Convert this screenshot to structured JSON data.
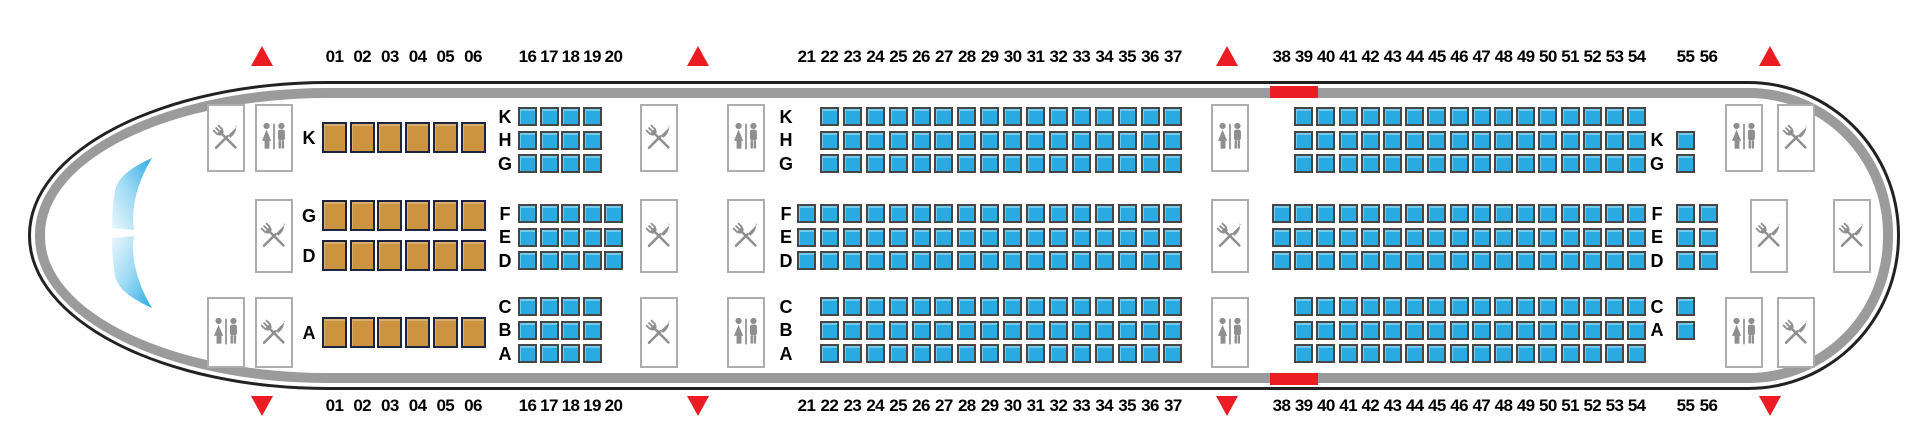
{
  "colors": {
    "economy_seat": "#29abe2",
    "economy_seat_border": "#464646",
    "business_seat": "#cd9440",
    "business_seat_border": "#1d2440",
    "fuselage_band": "#9b9b9b",
    "fuselage_outline": "#222222",
    "exit_marker": "#ec1c24",
    "icon_gray": "#8f8f8f",
    "text": "#000000"
  },
  "icons": {
    "galley": "crossed-fork-and-knife",
    "lavatory": "woman-and-man-figures",
    "exit": "red-triangle",
    "cockpit": "windshield-crescent-panes",
    "overwing_exit": "red-bar-on-fuselage"
  },
  "cabin": {
    "sections": [
      {
        "id": "business",
        "cabin_class": "business",
        "letters_visible": true,
        "columns": [
          "01",
          "02",
          "03",
          "04",
          "05",
          "06"
        ],
        "groups": [
          {
            "band": "top",
            "rows": [
              {
                "letter": "K",
                "from": "01",
                "to": "06"
              }
            ]
          },
          {
            "band": "mid",
            "rows": [
              {
                "letter": "G",
                "from": "01",
                "to": "06"
              },
              {
                "letter": "D",
                "from": "01",
                "to": "06"
              }
            ]
          },
          {
            "band": "bottom",
            "rows": [
              {
                "letter": "A",
                "from": "01",
                "to": "06"
              }
            ]
          }
        ]
      },
      {
        "id": "economy-front",
        "cabin_class": "economy",
        "letters_visible": true,
        "columns": [
          "16",
          "17",
          "18",
          "19",
          "20"
        ],
        "groups": [
          {
            "band": "top",
            "rows": [
              {
                "letter": "K",
                "from": "16",
                "to": "19"
              },
              {
                "letter": "H",
                "from": "16",
                "to": "19"
              },
              {
                "letter": "G",
                "from": "16",
                "to": "19"
              }
            ]
          },
          {
            "band": "mid",
            "rows": [
              {
                "letter": "F",
                "from": "16",
                "to": "20"
              },
              {
                "letter": "E",
                "from": "16",
                "to": "20"
              },
              {
                "letter": "D",
                "from": "16",
                "to": "20"
              }
            ]
          },
          {
            "band": "bottom",
            "rows": [
              {
                "letter": "C",
                "from": "16",
                "to": "19"
              },
              {
                "letter": "B",
                "from": "16",
                "to": "19"
              },
              {
                "letter": "A",
                "from": "16",
                "to": "19"
              }
            ]
          }
        ]
      },
      {
        "id": "economy-mid",
        "cabin_class": "economy",
        "letters_visible": true,
        "columns": [
          "21",
          "22",
          "23",
          "24",
          "25",
          "26",
          "27",
          "28",
          "29",
          "30",
          "31",
          "32",
          "33",
          "34",
          "35",
          "36",
          "37"
        ],
        "groups": [
          {
            "band": "top",
            "rows": [
              {
                "letter": "K",
                "from": "22",
                "to": "37"
              },
              {
                "letter": "H",
                "from": "22",
                "to": "37"
              },
              {
                "letter": "G",
                "from": "22",
                "to": "37"
              }
            ]
          },
          {
            "band": "mid",
            "rows": [
              {
                "letter": "F",
                "from": "21",
                "to": "37"
              },
              {
                "letter": "E",
                "from": "21",
                "to": "37"
              },
              {
                "letter": "D",
                "from": "21",
                "to": "37"
              }
            ]
          },
          {
            "band": "bottom",
            "rows": [
              {
                "letter": "C",
                "from": "22",
                "to": "37"
              },
              {
                "letter": "B",
                "from": "22",
                "to": "37"
              },
              {
                "letter": "A",
                "from": "22",
                "to": "37"
              }
            ]
          }
        ]
      },
      {
        "id": "economy-rear",
        "cabin_class": "economy",
        "letters_visible": false,
        "columns": [
          "38",
          "39",
          "40",
          "41",
          "42",
          "43",
          "44",
          "45",
          "46",
          "47",
          "48",
          "49",
          "50",
          "51",
          "52",
          "53",
          "54"
        ],
        "groups": [
          {
            "band": "top",
            "rows": [
              {
                "letter": "K",
                "from": "39",
                "to": "54"
              },
              {
                "letter": "H",
                "from": "39",
                "to": "54"
              },
              {
                "letter": "G",
                "from": "39",
                "to": "54"
              }
            ]
          },
          {
            "band": "mid",
            "rows": [
              {
                "letter": "F",
                "from": "38",
                "to": "54"
              },
              {
                "letter": "E",
                "from": "38",
                "to": "54"
              },
              {
                "letter": "D",
                "from": "38",
                "to": "54"
              }
            ]
          },
          {
            "band": "bottom",
            "rows": [
              {
                "letter": "C",
                "from": "39",
                "to": "54"
              },
              {
                "letter": "B",
                "from": "39",
                "to": "54"
              },
              {
                "letter": "A",
                "from": "39",
                "to": "54"
              }
            ]
          }
        ]
      },
      {
        "id": "economy-tail",
        "cabin_class": "economy",
        "letters_visible": true,
        "columns": [
          "55",
          "56"
        ],
        "groups": [
          {
            "band": "top",
            "rows": [
              {
                "letter": "K",
                "from": "55",
                "to": "55",
                "slot": 1
              },
              {
                "letter": "G",
                "from": "55",
                "to": "55",
                "slot": 2
              }
            ]
          },
          {
            "band": "mid",
            "rows": [
              {
                "letter": "F",
                "from": "55",
                "to": "56"
              },
              {
                "letter": "E",
                "from": "55",
                "to": "56"
              },
              {
                "letter": "D",
                "from": "55",
                "to": "56"
              }
            ]
          },
          {
            "band": "bottom",
            "rows": [
              {
                "letter": "C",
                "from": "55",
                "to": "55",
                "slot": 0
              },
              {
                "letter": "A",
                "from": "55",
                "to": "55",
                "slot": 1
              }
            ]
          }
        ]
      }
    ],
    "service_zones": [
      {
        "id": "front",
        "exit": true,
        "top": [
          "galley",
          "lavatory"
        ],
        "mid": [
          null,
          "galley"
        ],
        "bottom": [
          "lavatory",
          "galley"
        ]
      },
      {
        "id": "mid-front",
        "exit": true,
        "top": [
          "galley",
          "lavatory"
        ],
        "mid": [
          "galley",
          "galley"
        ],
        "bottom": [
          "galley",
          "lavatory"
        ]
      },
      {
        "id": "mid-rear",
        "exit": true,
        "top": [
          "lavatory"
        ],
        "mid": [
          "galley"
        ],
        "bottom": [
          "lavatory"
        ]
      },
      {
        "id": "rear",
        "exit": true,
        "top": [
          "lavatory",
          "galley"
        ],
        "mid": [
          "galley",
          "galley"
        ],
        "bottom": [
          "lavatory",
          "galley"
        ]
      }
    ],
    "overwing_exit_bars": {
      "at_rows": [
        "38",
        "39"
      ],
      "positions": [
        "top",
        "bottom"
      ]
    },
    "cockpit_windshield": true
  }
}
